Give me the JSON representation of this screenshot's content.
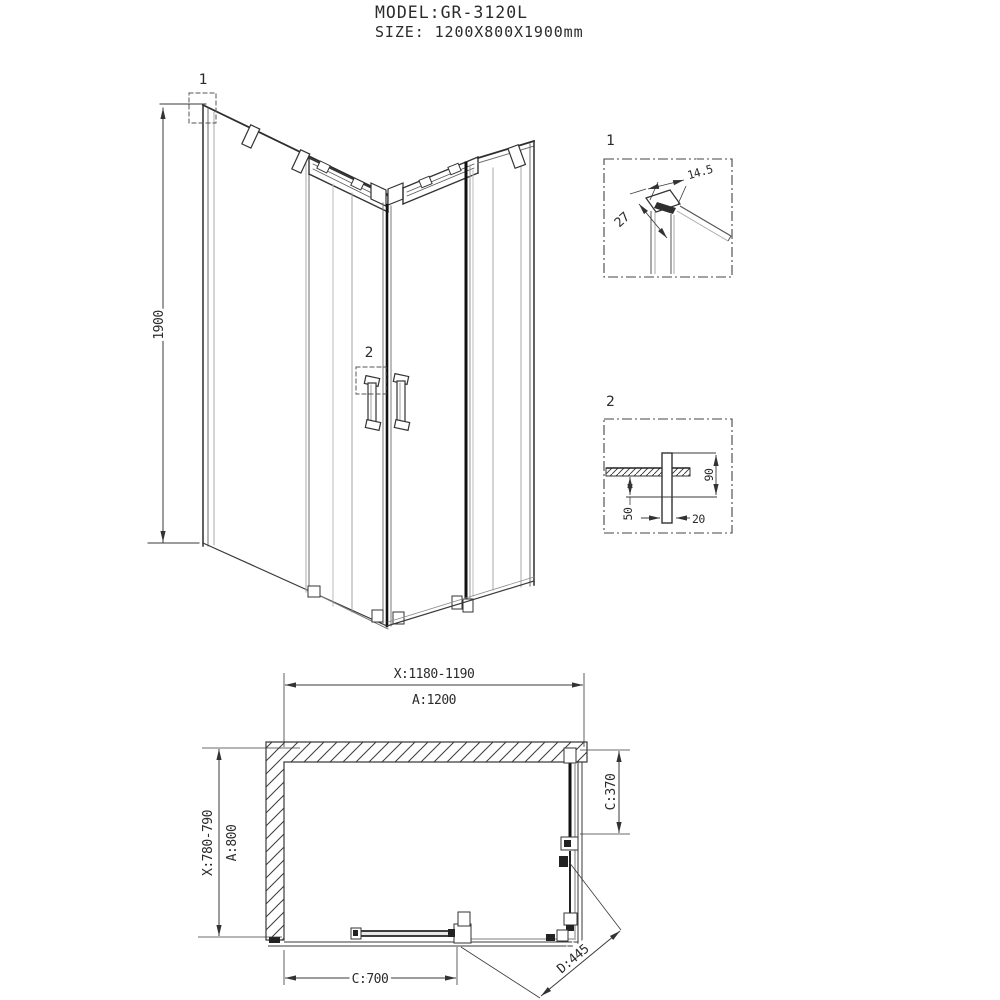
{
  "title_block": {
    "model": "MODEL:GR-3120L",
    "size": "SIZE: 1200X800X1900mm"
  },
  "isometric_view": {
    "height_dim_label": "1900",
    "callouts": {
      "top_corner_detail": "1",
      "handle_detail": "2"
    }
  },
  "detail_views": {
    "detail_1": {
      "label": "1",
      "profile_width_dim": "14.5",
      "profile_depth_dim": "27"
    },
    "detail_2": {
      "label": "2",
      "handle_height_dim": "90",
      "handle_offset_dim": "50",
      "handle_width_dim": "20"
    }
  },
  "plan_view": {
    "width_adjust_dim": "X:1180-1190",
    "width_nominal_dim": "A:1200",
    "depth_adjust_dim": "X:780-790",
    "depth_nominal_dim": "A:800",
    "side_panel_dim": "C:370",
    "front_door_dim": "C:700",
    "diagonal_entry_dim": "D:445"
  },
  "colors": {
    "line": "#3a3a3a",
    "thick_line": "#111111",
    "glass_line": "#a9a9a9",
    "background": "#ffffff"
  }
}
